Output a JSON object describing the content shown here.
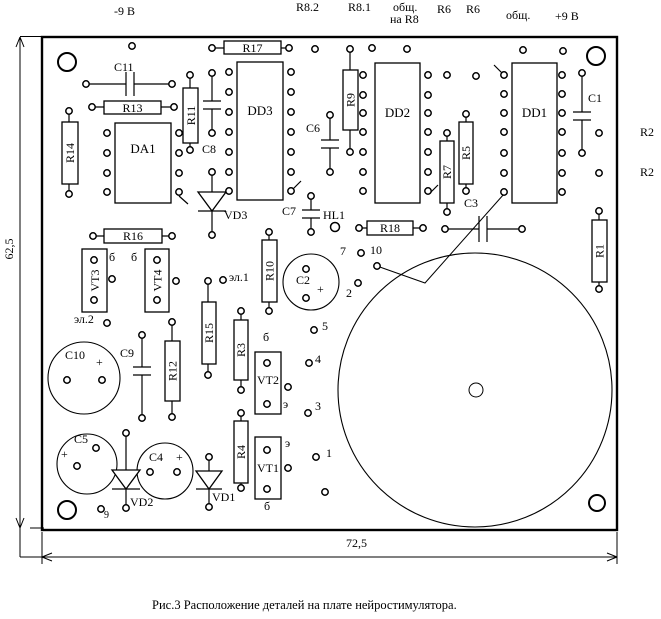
{
  "caption": "Рис.3 Расположение деталей на плате нейростимулятора.",
  "dims": {
    "h": "62,5",
    "w": "72,5"
  },
  "top": {
    "m9": "-9 В",
    "r82": "R8.2",
    "r81": "R8.1",
    "obsh1": "общ.",
    "obsh1b": "на R8",
    "r6a": "R6",
    "r6b": "R6",
    "obsh2": "общ.",
    "p9": "+9 В"
  },
  "right": {
    "r2a": "R2",
    "r2b": "R2"
  },
  "comp": {
    "R1": "R1",
    "R3": "R3",
    "R4": "R4",
    "R5": "R5",
    "R7": "R7",
    "R9": "R9",
    "R10": "R10",
    "R11": "R11",
    "R12": "R12",
    "R13": "R13",
    "R14": "R14",
    "R15": "R15",
    "R16": "R16",
    "R17": "R17",
    "R18": "R18",
    "C1": "C1",
    "C2": "C2",
    "C3": "C3",
    "C4": "C4",
    "C5": "C5",
    "C6": "C6",
    "C7": "C7",
    "C8": "C8",
    "C9": "C9",
    "C10": "C10",
    "C11": "C11",
    "DA1": "DA1",
    "DD1": "DD1",
    "DD2": "DD2",
    "DD3": "DD3",
    "VT1": "VT1",
    "VT2": "VT2",
    "VT3": "VT3",
    "VT4": "VT4",
    "VD1": "VD1",
    "VD2": "VD2",
    "VD3": "VD3",
    "HL1": "HL1"
  },
  "padnums": {
    "n1": "1",
    "n2": "2",
    "n3": "3",
    "n4": "4",
    "n5": "5",
    "n7": "7",
    "n9": "9",
    "n10": "10",
    "el1": "эл.1",
    "el2": "эл.2"
  },
  "pins": {
    "b": "б",
    "e": "э"
  },
  "plus": "+",
  "colors": {
    "ink": "#000000",
    "paper": "#ffffff"
  }
}
